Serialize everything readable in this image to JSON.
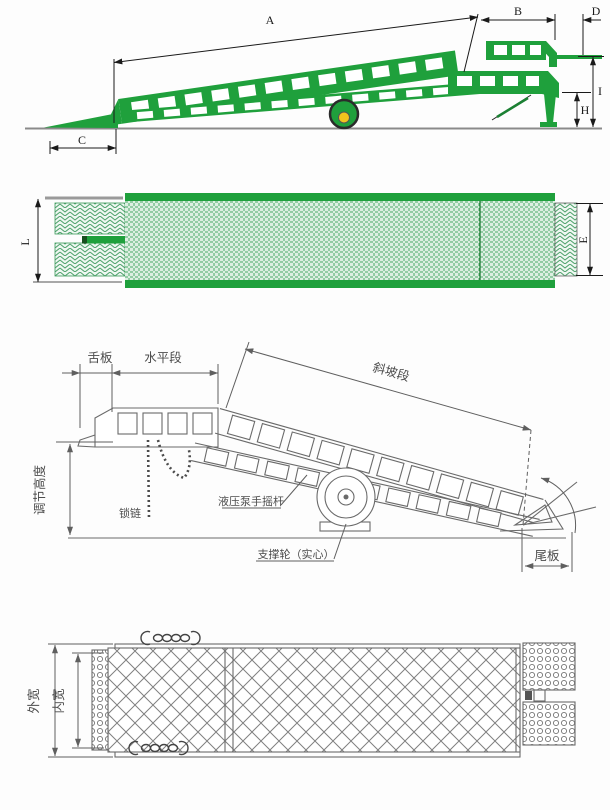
{
  "colors": {
    "ramp_green": "#1fa03c",
    "ramp_green_dark": "#157a2c",
    "wheel_hub_yellow": "#f2c41d",
    "dimension_line": "#1a1a1a",
    "sketch_line": "#6a6a6a",
    "ground_line": "#8a8a8a",
    "deck_fill_light": "#ddefe2"
  },
  "side_view": {
    "labels": {
      "a": "A",
      "b": "B",
      "c": "C",
      "d": "D",
      "h": "H",
      "i": "I"
    }
  },
  "plan_view": {
    "labels": {
      "l": "L",
      "e": "E"
    }
  },
  "sketch_side_view": {
    "labels": {
      "tongue_plate": "舌板",
      "horizontal_section": "水平段",
      "slope_section": "斜坡段",
      "adjustable_height": "调节高度",
      "chain": "锁链",
      "hydraulic_pump_lever": "液压泵手摇杆",
      "support_wheel": "支撑轮（实心）",
      "tail_plate": "尾板"
    }
  },
  "sketch_plan_view": {
    "labels": {
      "outer_width": "外宽",
      "inner_width": "内宽"
    }
  }
}
